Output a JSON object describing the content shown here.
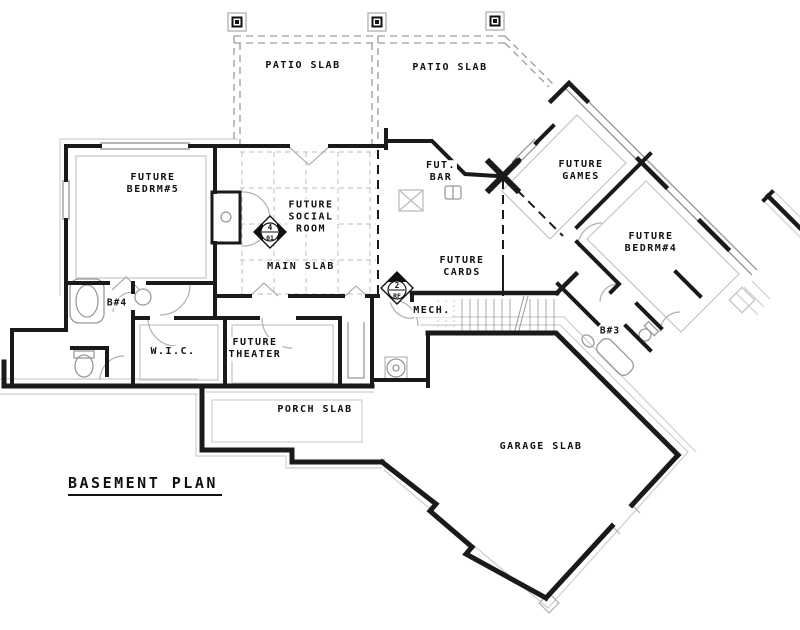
{
  "title": {
    "text": "BASEMENT PLAN"
  },
  "labels": {
    "patio1": "PATIO SLAB",
    "patio2": "PATIO SLAB",
    "bedrm5": "FUTURE\nBEDRM#5",
    "social": "FUTURE\nSOCIAL\nROOM",
    "main_slab": "MAIN SLAB",
    "bar": "FUT.\nBAR",
    "games": "FUTURE\nGAMES",
    "cards": "FUTURE\nCARDS",
    "bedrm4": "FUTURE\nBEDRM#4",
    "b4": "B#4",
    "b3": "B#3",
    "wic": "W.I.C.",
    "mech": "MECH.",
    "theater": "FUTURE\nTHEATER",
    "porch": "PORCH SLAB",
    "garage": "GARAGE SLAB"
  },
  "symbols": {
    "social_marker": {
      "top": "4",
      "bottom": "01"
    },
    "mech_marker": {
      "top": "2",
      "bottom": "RF"
    }
  },
  "colors": {
    "wall": "#1a1a1a",
    "detail": "#9a9a9a",
    "light": "#c9c9c9",
    "background": "#ffffff"
  }
}
